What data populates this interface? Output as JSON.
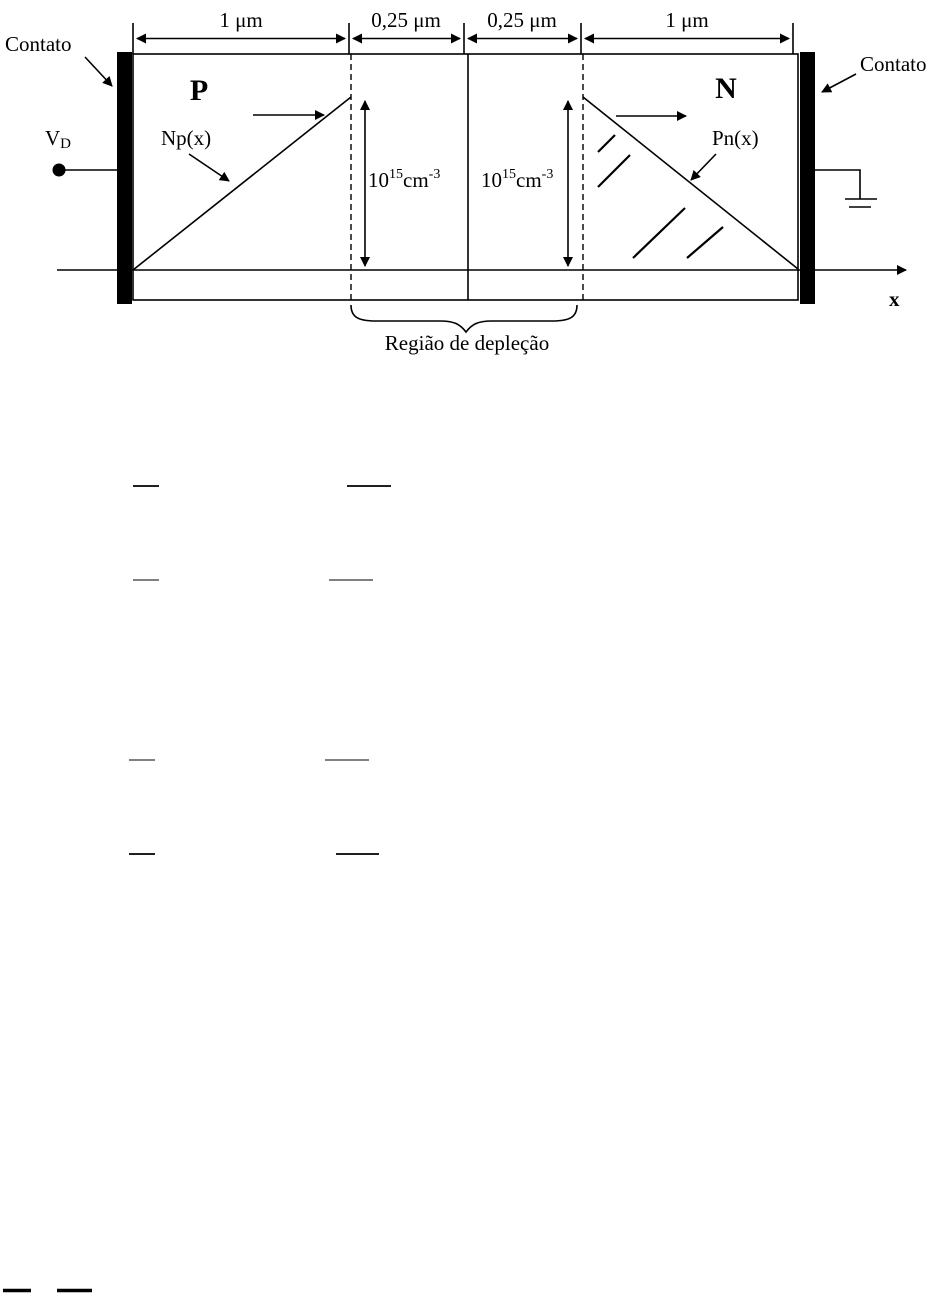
{
  "page": {
    "background": "#ffffff"
  },
  "colors": {
    "ink": "#000000",
    "faint_gray": "#808080"
  },
  "dimensions": {
    "seg1": "1 μm",
    "seg2": "0,25 μm",
    "seg3": "0,25 μm",
    "seg4": "1 μm"
  },
  "contacts": {
    "left": "Contato",
    "right": "Contato"
  },
  "terminal": {
    "base": "V",
    "sub": "D"
  },
  "regions": {
    "p": "P",
    "n": "N"
  },
  "profiles": {
    "np": "Np(x)",
    "pn": "Pn(x)"
  },
  "concentration": {
    "base": "10",
    "exponent": "15",
    "unit": "cm",
    "unit_exponent": "-3"
  },
  "axis": {
    "label": "x"
  },
  "depletion": {
    "label": "Região de depleção"
  }
}
